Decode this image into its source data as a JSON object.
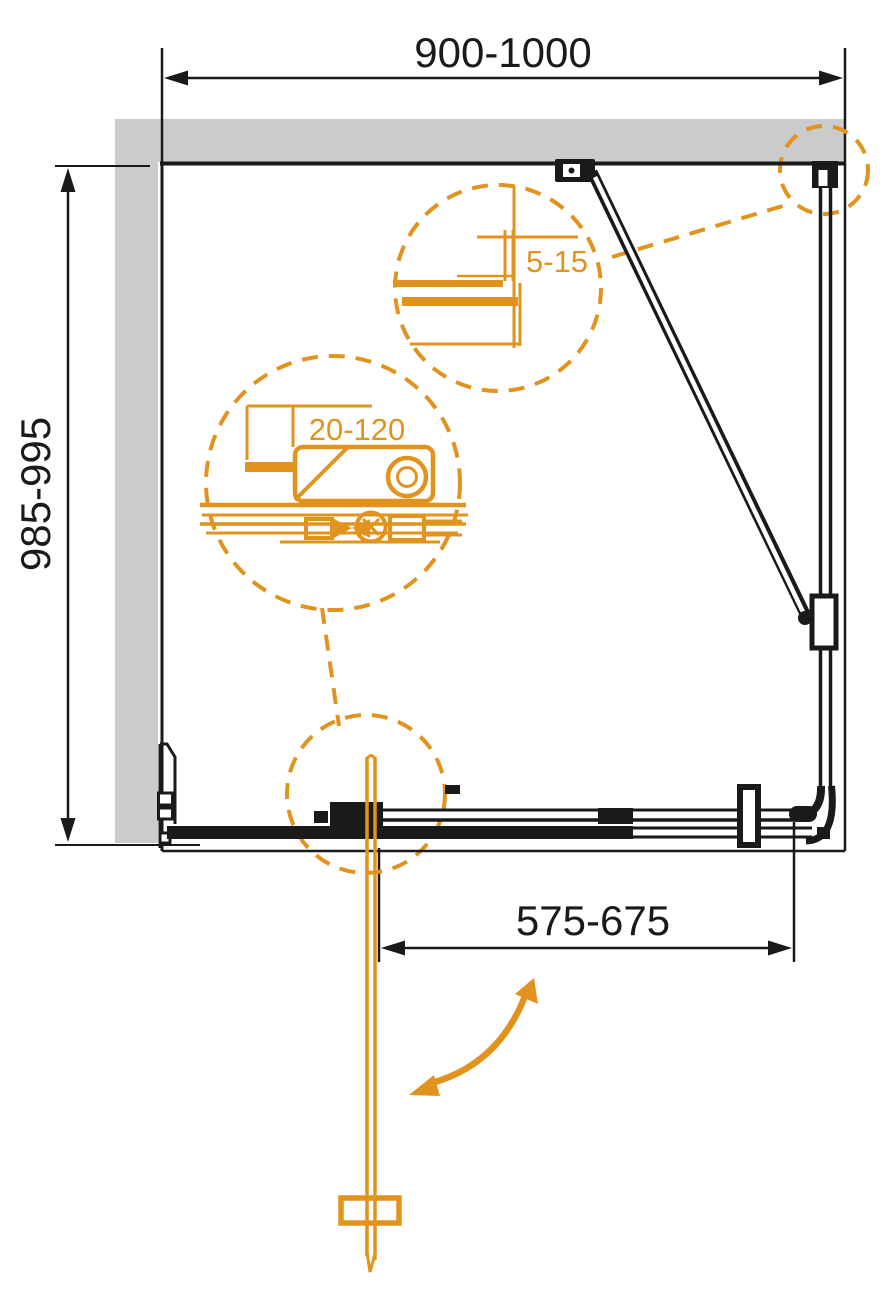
{
  "diagram": {
    "type": "technical-drawing",
    "subject": "shower-enclosure-plan-view",
    "dimensions": {
      "top_width": "900-1000",
      "side_depth": "985-995",
      "entry_width": "575-675",
      "detail_wall_profile_adjustment": "5-15",
      "detail_bracket_adjustment": "20-120"
    },
    "colors": {
      "accent_orange": "#E2931D",
      "wall_gray": "#CBCBCB",
      "line_black": "#1A1A1A",
      "background": "#FFFFFF"
    }
  }
}
